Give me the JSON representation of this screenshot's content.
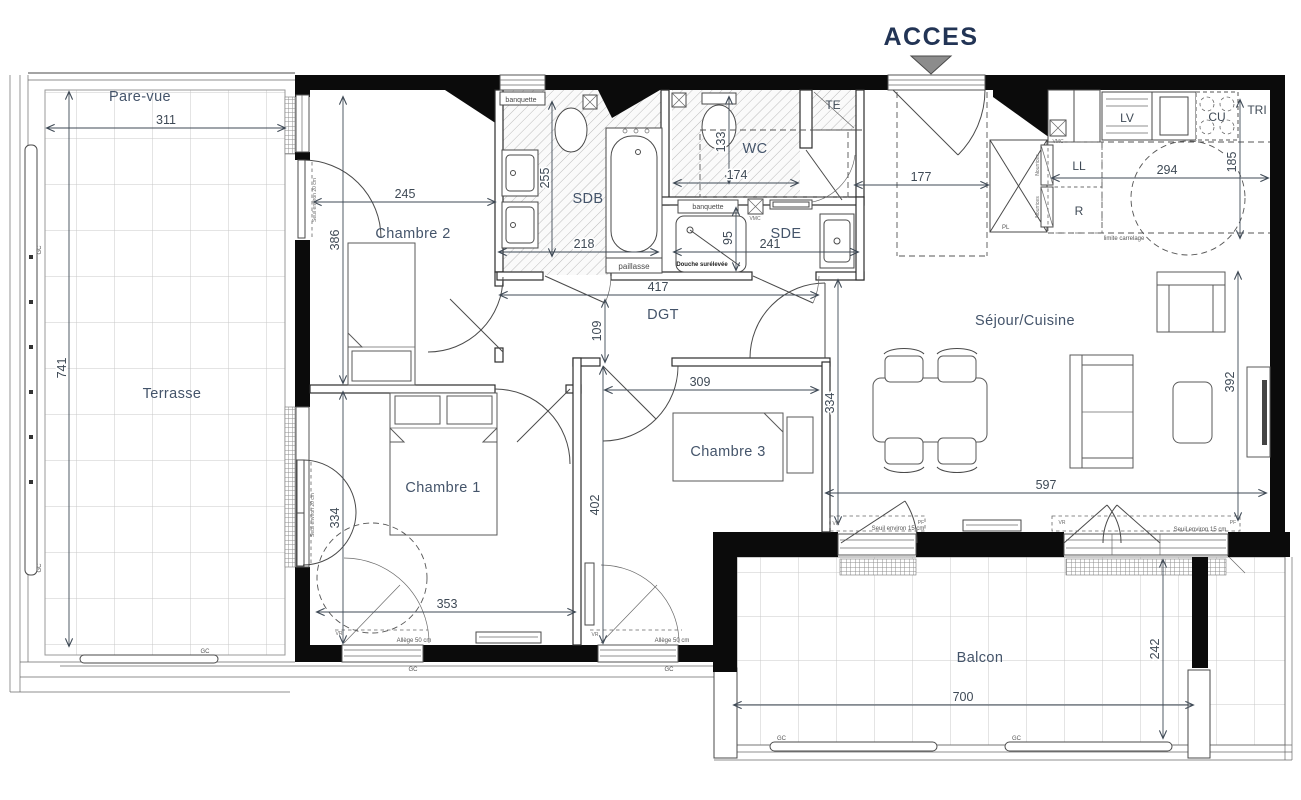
{
  "header": {
    "acces": "ACCES"
  },
  "rooms": {
    "pare_vue": "Pare-vue",
    "terrasse": "Terrasse",
    "chambre2": "Chambre 2",
    "sdb": "SDB",
    "wc": "WC",
    "sde": "SDE",
    "dgt": "DGT",
    "chambre1": "Chambre 1",
    "chambre3": "Chambre 3",
    "sejour_cuisine": "Séjour/Cuisine",
    "balcon": "Balcon"
  },
  "dimensions": {
    "pare_vue_width": "311",
    "terrasse_height": "741",
    "chambre2_width": "245",
    "chambre2_height": "386",
    "sdb_height": "255",
    "sdb_width": "218",
    "wc_height": "133",
    "wc_width": "174",
    "entree_width": "177",
    "cuisine_width": "294",
    "cuisine_depth": "185",
    "sde_height": "95",
    "sde_width": "241",
    "dgt_width": "417",
    "dgt_height": "109",
    "chambre3_width": "309",
    "sejour_height": "334",
    "chambre3_depth": "402",
    "chambre1_width": "353",
    "chambre1_height": "334",
    "sejour_depth": "392",
    "sejour_width": "597",
    "balcon_width": "700",
    "balcon_depth": "242"
  },
  "equipment": {
    "lv": "LV",
    "cu": "CU",
    "tri": "TRI",
    "ll": "LL",
    "r": "R",
    "te": "TE",
    "pl": "PL",
    "vmc": "VMC",
    "nourrices": "Nourrices"
  },
  "annotations": {
    "banquette": "banquette",
    "paillasse": "paillasse",
    "douche_surelevee": "Douche surélevée",
    "limite_carrelage": "limite carrelage",
    "vr": "VR",
    "pf": "PF",
    "gc": "GC",
    "seuil_15": "Seuil environ 15 cm",
    "seuil_20": "Seuil environ 20 cm",
    "allege_50": "Allège 50 cm"
  },
  "colors": {
    "acces_text": "#223455",
    "walls": "#0b0b0b",
    "labels": "#44546a",
    "arrow_triangle": "#8c8c8c",
    "hatch": "#bbbbbb"
  }
}
